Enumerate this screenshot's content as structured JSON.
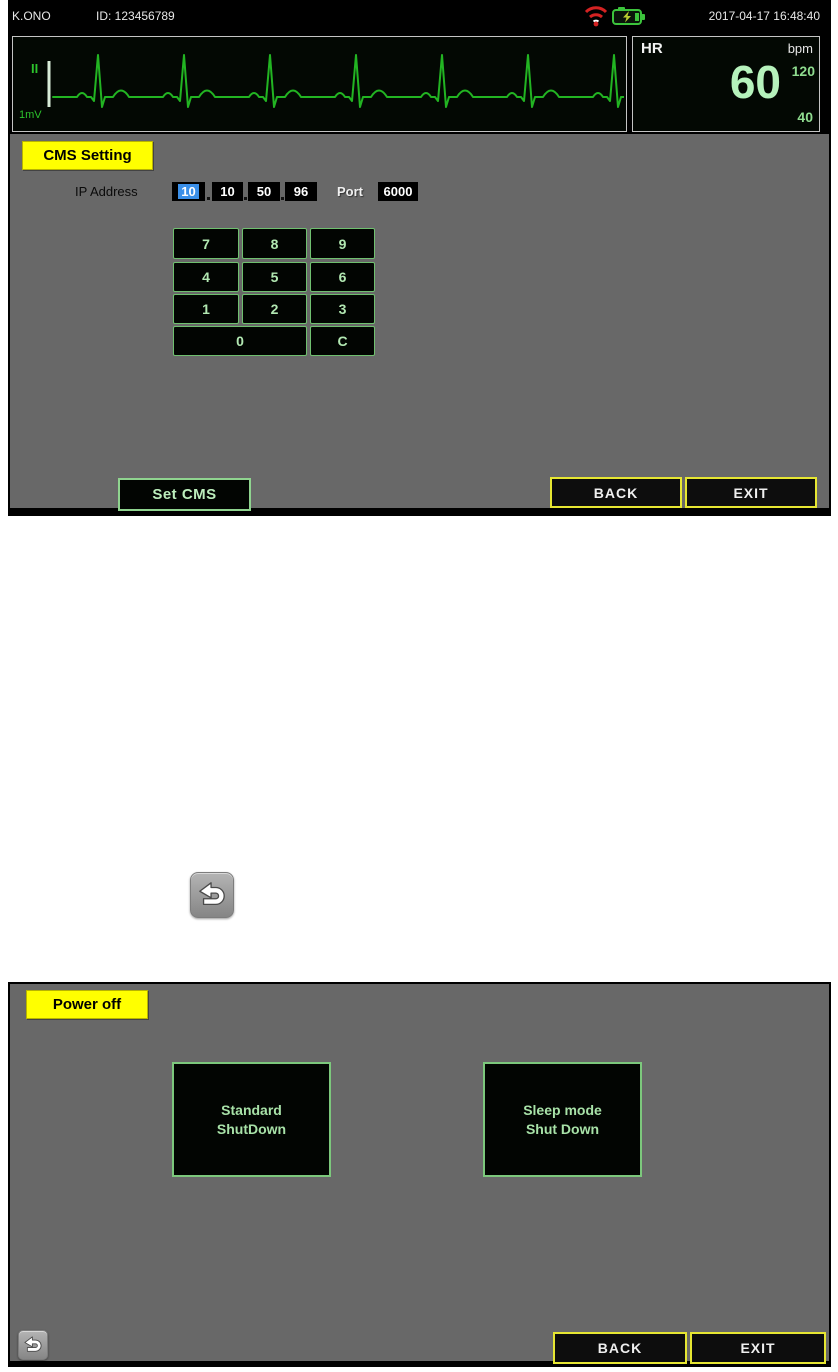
{
  "monitor": {
    "topbar": {
      "patient_name": "K.ONO",
      "patient_id": "ID: 123456789",
      "datetime": "2017-04-17 16:48:40",
      "wifi_icon": "wifi-signal-red",
      "battery_icon": "battery-charging-green"
    },
    "ecg": {
      "lead": "II",
      "calibration": "1mV"
    },
    "hr": {
      "label": "HR",
      "unit": "bpm",
      "value": "60",
      "limit_high": "120",
      "limit_low": "40"
    },
    "cms": {
      "title": "CMS Setting",
      "ip_label": "IP Address",
      "octets": [
        "10",
        "10",
        "50",
        "96"
      ],
      "port_label": "Port",
      "port_value": "6000",
      "keys": [
        "7",
        "8",
        "9",
        "4",
        "5",
        "6",
        "1",
        "2",
        "3",
        "0",
        "C"
      ],
      "set_cms_label": "Set CMS",
      "back_label": "BACK",
      "exit_label": "EXIT"
    }
  },
  "power": {
    "title": "Power off",
    "standard_shutdown": {
      "line1": "Standard",
      "line2": "ShutDown"
    },
    "sleep_shutdown": {
      "line1": "Sleep mode",
      "line2": "Shut Down"
    },
    "back_label": "BACK",
    "exit_label": "EXIT"
  },
  "colors": {
    "label_yellow": "#ffff00",
    "button_yellow_border": "#e6e632",
    "key_green_border": "#6fc06f",
    "key_green_text": "#b2e8b2",
    "ecg_trace_green": "#22b422",
    "hr_value_green": "#b6f2bc",
    "selected_octet_blue": "#3a8fe8",
    "panel_gray": "#686868"
  }
}
